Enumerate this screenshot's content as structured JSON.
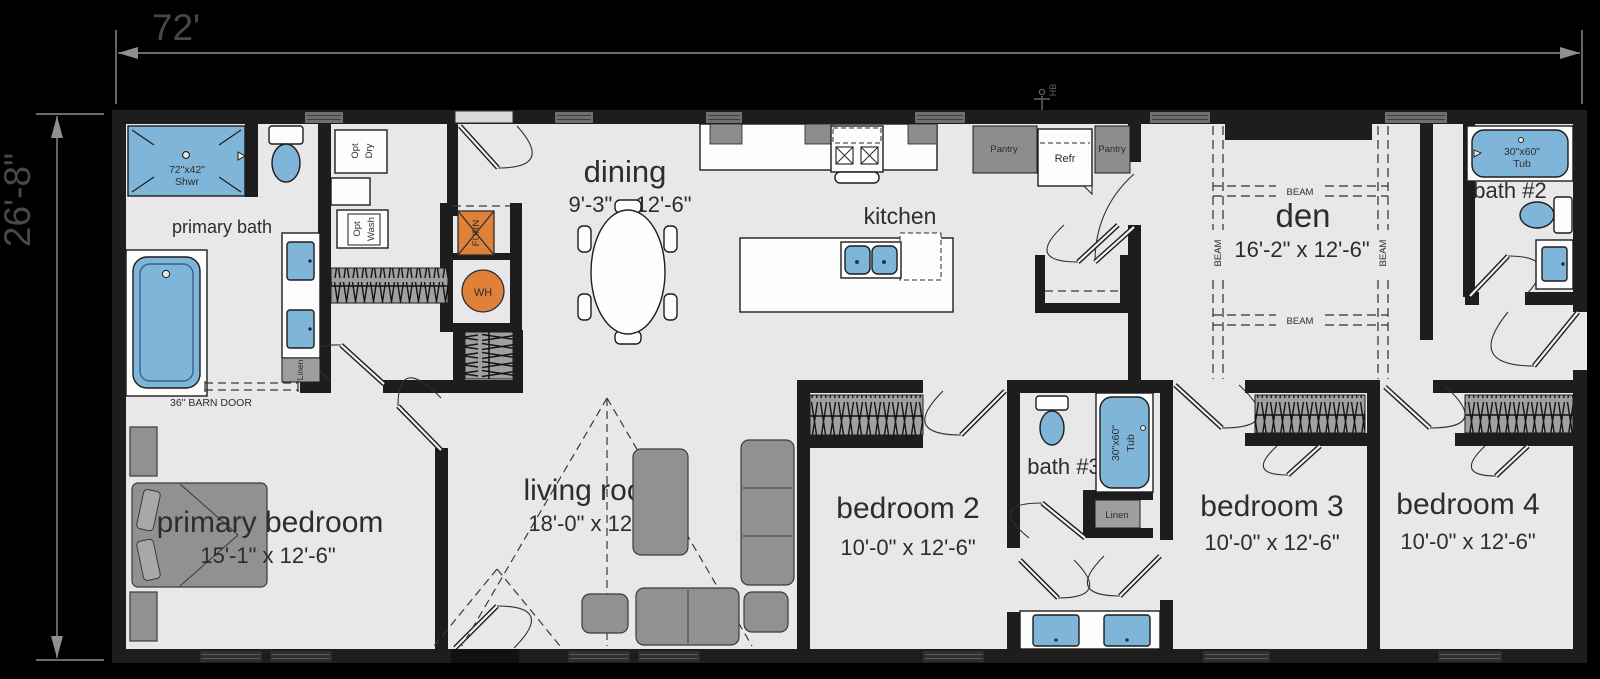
{
  "dimensions": {
    "overall_width": "72'",
    "overall_depth": "26'-8\""
  },
  "rooms": {
    "primary_bath": {
      "name": "primary bath"
    },
    "primary_bedroom": {
      "name": "primary bedroom",
      "size": "15'-1\" x 12'-6\""
    },
    "dining": {
      "name": "dining",
      "size": "9'-3\" x 12'-6\""
    },
    "kitchen": {
      "name": "kitchen"
    },
    "living_room": {
      "name": "living room",
      "size": "18'-0\" x 12'-6\""
    },
    "den": {
      "name": "den",
      "size": "16'-2\" x 12'-6\""
    },
    "bath_2": {
      "name": "bath #2"
    },
    "bath_3": {
      "name": "bath #3"
    },
    "bedroom_2": {
      "name": "bedroom 2",
      "size": "10'-0\" x 12'-6\""
    },
    "bedroom_3": {
      "name": "bedroom 3",
      "size": "10'-0\" x 12'-6\""
    },
    "bedroom_4": {
      "name": "bedroom 4",
      "size": "10'-0\" x 12'-6\""
    }
  },
  "fixtures": {
    "shower_size": "72\"x42\"",
    "shower_abbr": "Shwr",
    "tub_size": "30\"x60\"",
    "tub_abbr": "Tub",
    "opt_word": "Opt",
    "dry_word": "Dry",
    "wash_word": "Wash",
    "furnace_abbr": "FURN",
    "water_heater_abbr": "WH",
    "pantry_label": "Pantry",
    "refrigerator_abbr": "Refr",
    "linen_label": "Linen",
    "hose_bib_abbr": "HB"
  },
  "annotations": {
    "barn_door_note": "36\" BARN DOOR",
    "beam_label": "BEAM"
  },
  "colors": {
    "background": "#000000",
    "floor": "#e8e8ea",
    "walls": "#1d1d1d",
    "fixture_blue": "#7eb5d8",
    "utility_orange": "#e0813a",
    "furniture_gray": "#919191",
    "dimension_text": "#484848"
  }
}
